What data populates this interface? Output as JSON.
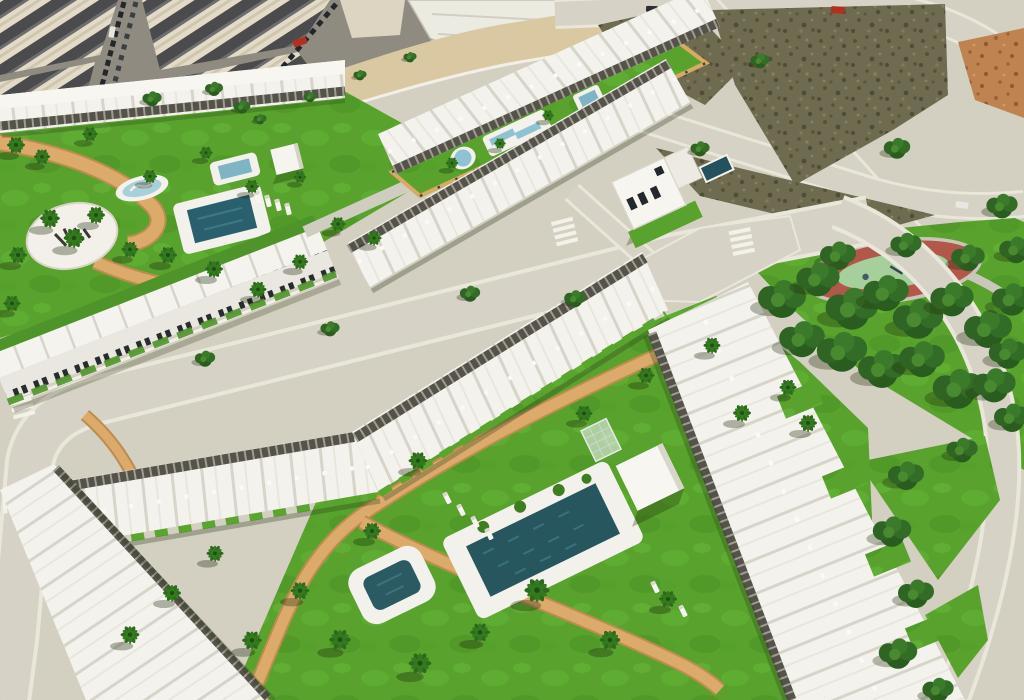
{
  "scene": {
    "type": "aerial-3d-render",
    "description": "Aerial 3D visualisation of a coastal residential development: rows of white townhouses and apartment blocks with grey pergolas arranged around landscaped communal gardens with dark turquoise swimming pools, palm trees and sand-coloured walking paths; bordered by an existing town block at top left, empty scrub building plots and new roads at top right, and a public park with mature trees and an oval playground on the right.",
    "areas": {
      "old_town": "Existing town block with street parking",
      "vacant_plots": "Undeveloped scrub plots between new roads",
      "upper_phase": "Two townhouse rows around a long communal lawn with three pools",
      "left_garden": "Communal garden with circular logo plaza, splash pool and lap pool",
      "villa": "Detached two-storey corner villa with private pool",
      "lower_phase": "Apartment blocks around a large lawn with main pool and kids pool",
      "public_park": "Public park with mature trees and oval playground",
      "plaza_logo": "Illegible developer logo painted on the circular plaza"
    },
    "palette": {
      "grass": "#58a22d",
      "grass_light": "#68b43a",
      "path_tan": "#dcab6b",
      "sand": "#d9c8a2",
      "road": "#d6d2c5",
      "road_edge": "#e9e6da",
      "sidewalk": "#c8c4b6",
      "building_white": "#f3f2ec",
      "building_shade": "#d9d7cc",
      "pergola_grey": "#57544b",
      "water_dark": "#27565f",
      "water_light": "#8fc3d4",
      "scrub": "#6f6b50",
      "dirt_orange": "#bf8352",
      "tree_dark": "#2a5c20",
      "playground_track": "#b2584a",
      "playground_centre": "#a7cf9c",
      "car_red": "#b03022"
    }
  }
}
